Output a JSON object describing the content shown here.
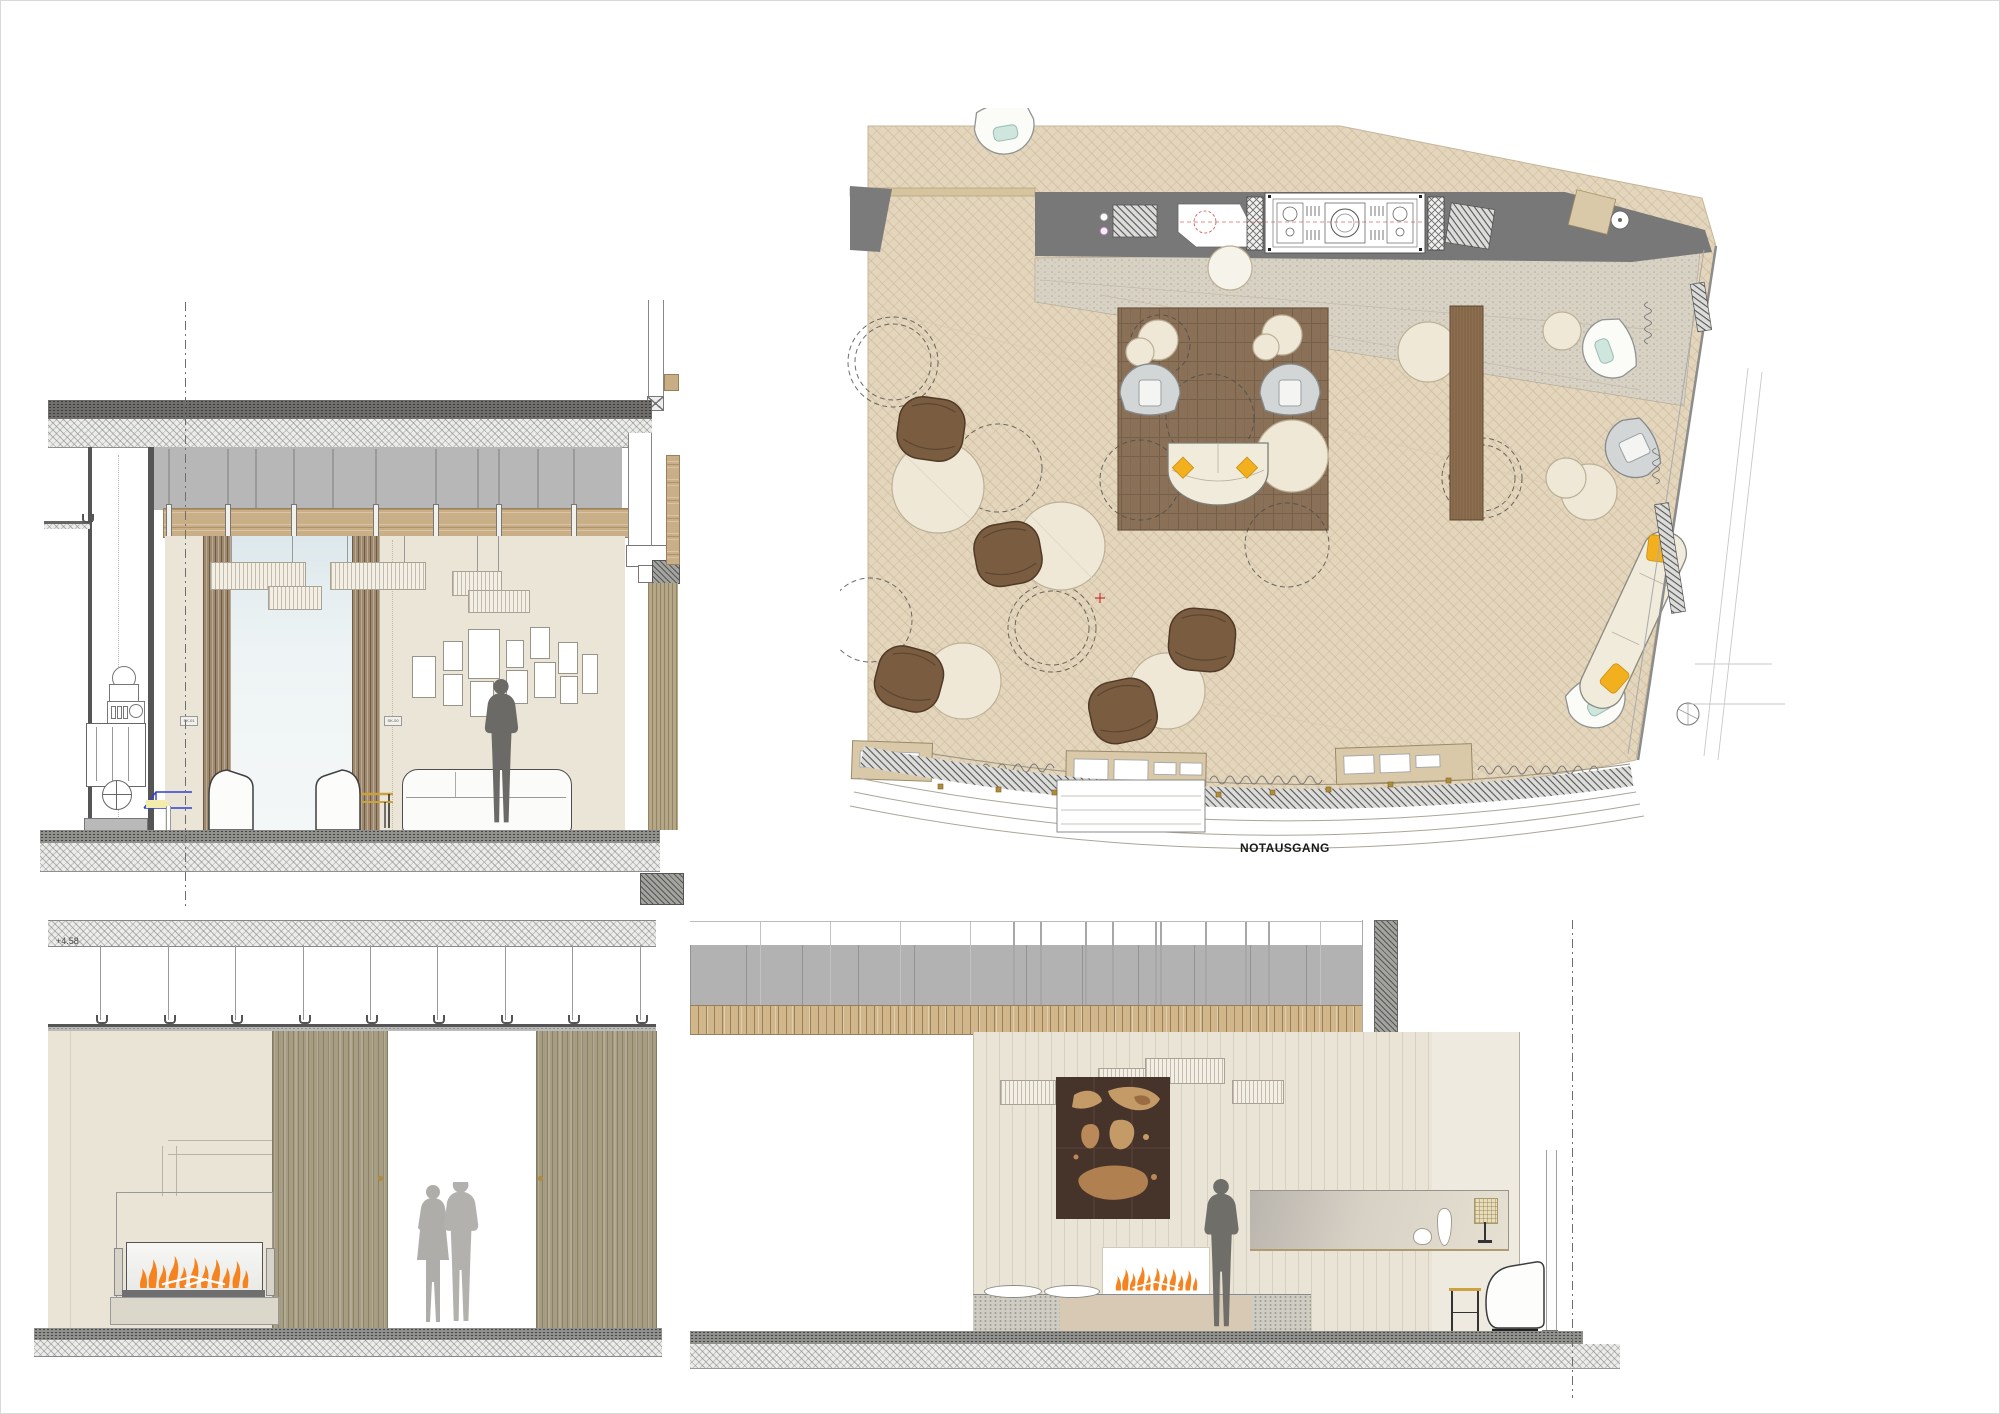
{
  "plan": {
    "exit_label": "NOTAUSGANG"
  },
  "sections": {
    "level_marker": "+4.58",
    "marker_a": "SK-01",
    "marker_b": "SK-00"
  },
  "colors": {
    "accent_yellow": "#F2B01E",
    "flame_orange": "#F5831F",
    "rug_brown": "#8A7057",
    "pouf_brown": "#7A5C41",
    "parquet_tan": "#E4D6BC",
    "wall_beige": "#E9E4D6",
    "ceiling_gray": "#B2B2B2",
    "window_blue": "#E3EDF1",
    "silhouette_gray": "#6F6E68"
  }
}
